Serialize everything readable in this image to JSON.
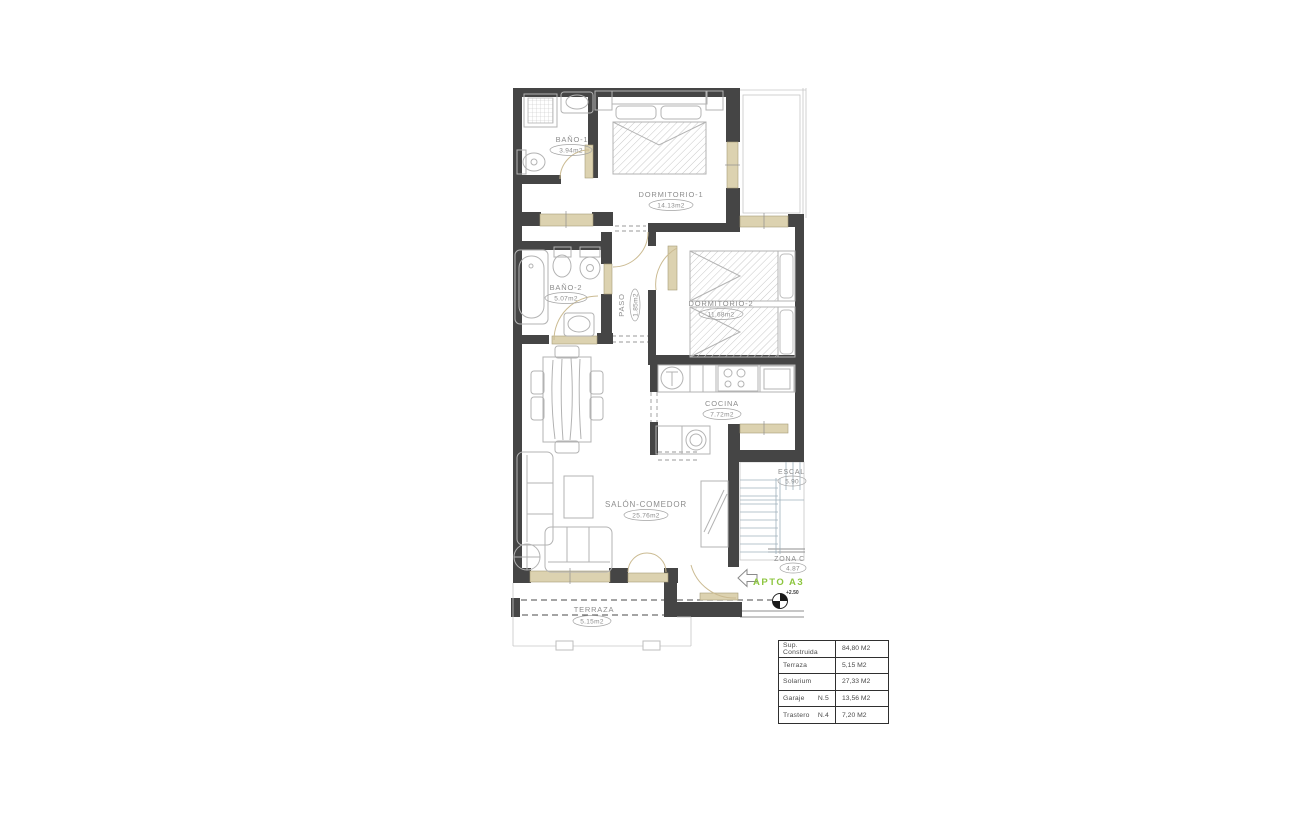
{
  "plan": {
    "rooms": [
      {
        "id": "bano1",
        "name": "BAÑO-1",
        "area": "3.94m2"
      },
      {
        "id": "dormitorio1",
        "name": "DORMITORIO-1",
        "area": "14.13m2"
      },
      {
        "id": "bano2",
        "name": "BAÑO-2",
        "area": "5.07m2"
      },
      {
        "id": "paso",
        "name": "PASO",
        "area": "1.85m2"
      },
      {
        "id": "dormitorio2",
        "name": "DORMITORIO-2",
        "area": "11.68m2"
      },
      {
        "id": "cocina",
        "name": "COCINA",
        "area": "7.72m2"
      },
      {
        "id": "salon",
        "name": "SALÓN-COMEDOR",
        "area": "25.76m2"
      },
      {
        "id": "terraza",
        "name": "TERRAZA",
        "area": "5.15m2"
      },
      {
        "id": "escalera",
        "name": "ESCAL",
        "area": "5.90"
      },
      {
        "id": "zona-comun",
        "name": "ZONA  C",
        "area": "4.87"
      }
    ],
    "annotations": {
      "apartment": "APTO A3",
      "level": "+2.50"
    },
    "colors": {
      "wall": "#454545",
      "window": "#dcd2b0",
      "accent_green": "#8dc63f"
    }
  },
  "summary_table": {
    "rows": [
      {
        "label": "Sup. Construida",
        "sub": "",
        "value": "84,80 M2"
      },
      {
        "label": "Terraza",
        "sub": "",
        "value": "5,15 M2"
      },
      {
        "label": "Solarium",
        "sub": "",
        "value": "27,33 M2"
      },
      {
        "label": "Garaje",
        "sub": "N.5",
        "value": "13,56 M2"
      },
      {
        "label": "Trastero",
        "sub": "N.4",
        "value": "7,20 M2"
      }
    ]
  }
}
